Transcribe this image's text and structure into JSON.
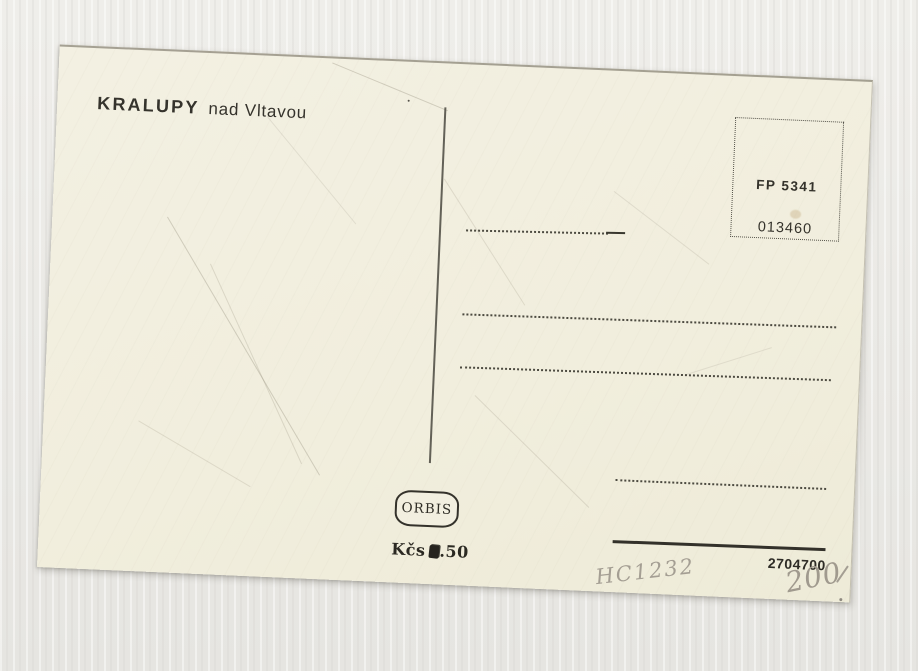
{
  "scene": {
    "background_color": "#eae9e5",
    "card_color": "#f1eedd",
    "ink_color": "#33312b",
    "pencil_color": "#a49e93"
  },
  "postcard": {
    "title": {
      "main": "KRALUPY",
      "sub": "nad Vltavou"
    },
    "stamp_box": {
      "code": "FP 5341",
      "serial": "013460"
    },
    "publisher": {
      "name": "ORBIS",
      "price_currency": "Kčs",
      "price_fraction": ".50"
    },
    "print_number": "2704700",
    "handwriting": {
      "code": "HC1232",
      "number": "200"
    }
  }
}
